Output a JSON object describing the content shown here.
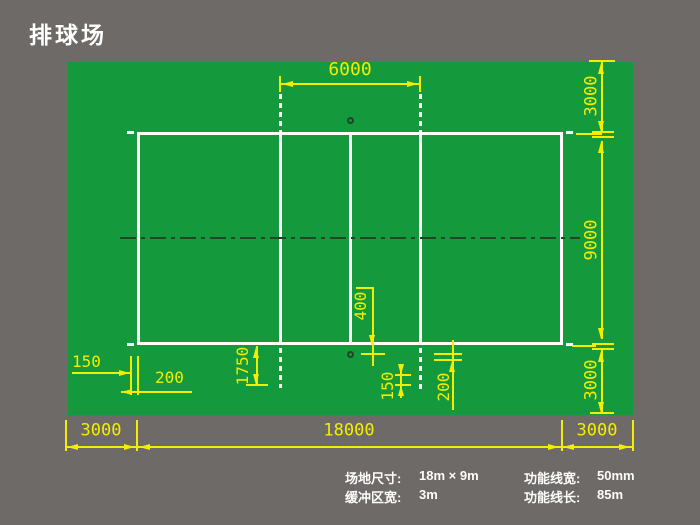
{
  "title": "排球场",
  "colors": {
    "background": "#6d6a67",
    "field_green": "#149a3c",
    "court_line_white": "#ffffff",
    "dimension_yellow": "#f3ed00",
    "center_axis_dark": "#1c4726"
  },
  "dims": {
    "d6000": "6000",
    "right_3000_top": "3000",
    "right_9000": "9000",
    "right_3000_bottom": "3000",
    "bottom_3000_left": "3000",
    "bottom_18000": "18000",
    "bottom_3000_right": "3000",
    "left_150": "150",
    "left_200": "200",
    "d1750": "1750",
    "d400": "400",
    "center_150": "150",
    "center_200": "200"
  },
  "legend": {
    "items": [
      {
        "label": "场地尺寸:",
        "value": "18m × 9m"
      },
      {
        "label": "缓冲区宽:",
        "value": "3m"
      },
      {
        "label": "功能线宽:",
        "value": "50mm"
      },
      {
        "label": "功能线长:",
        "value": "85m"
      }
    ]
  }
}
